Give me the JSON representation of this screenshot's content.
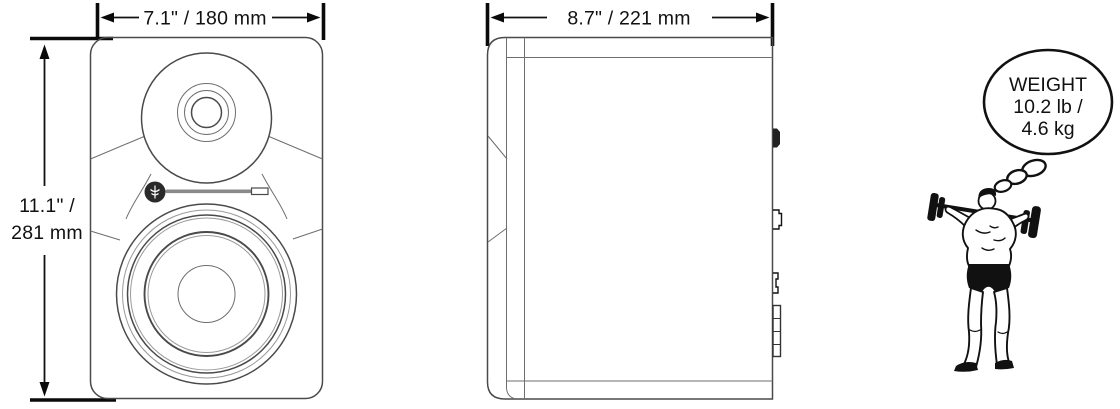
{
  "diagram_title": "studio-monitor-dimension-diagram",
  "colors": {
    "background": "#ffffff",
    "drawing_outline": "#4a4a4a",
    "drawing_light": "#9a9a9a",
    "dimension_ink": "#111111",
    "badge_fill": "#2a2a2a"
  },
  "labels": {
    "front_width": "7.1\" / 180 mm",
    "front_height_line1": "11.1\" /",
    "front_height_line2": "281 mm",
    "side_depth": "8.7\" / 221 mm",
    "weight_title": "WEIGHT",
    "weight_lb": "10.2 lb /",
    "weight_kg": "4.6 kg"
  },
  "measurements": {
    "width_in": 7.1,
    "width_mm": 180,
    "height_in": 11.1,
    "height_mm": 281,
    "depth_in": 8.7,
    "depth_mm": 221,
    "weight_lb": 10.2,
    "weight_kg": 4.6
  },
  "icons": [
    "speaker-front-view-icon",
    "speaker-side-view-icon",
    "tweeter-icon",
    "woofer-icon",
    "brand-badge-icon",
    "thought-bubble-icon",
    "strongman-barbell-icon"
  ]
}
